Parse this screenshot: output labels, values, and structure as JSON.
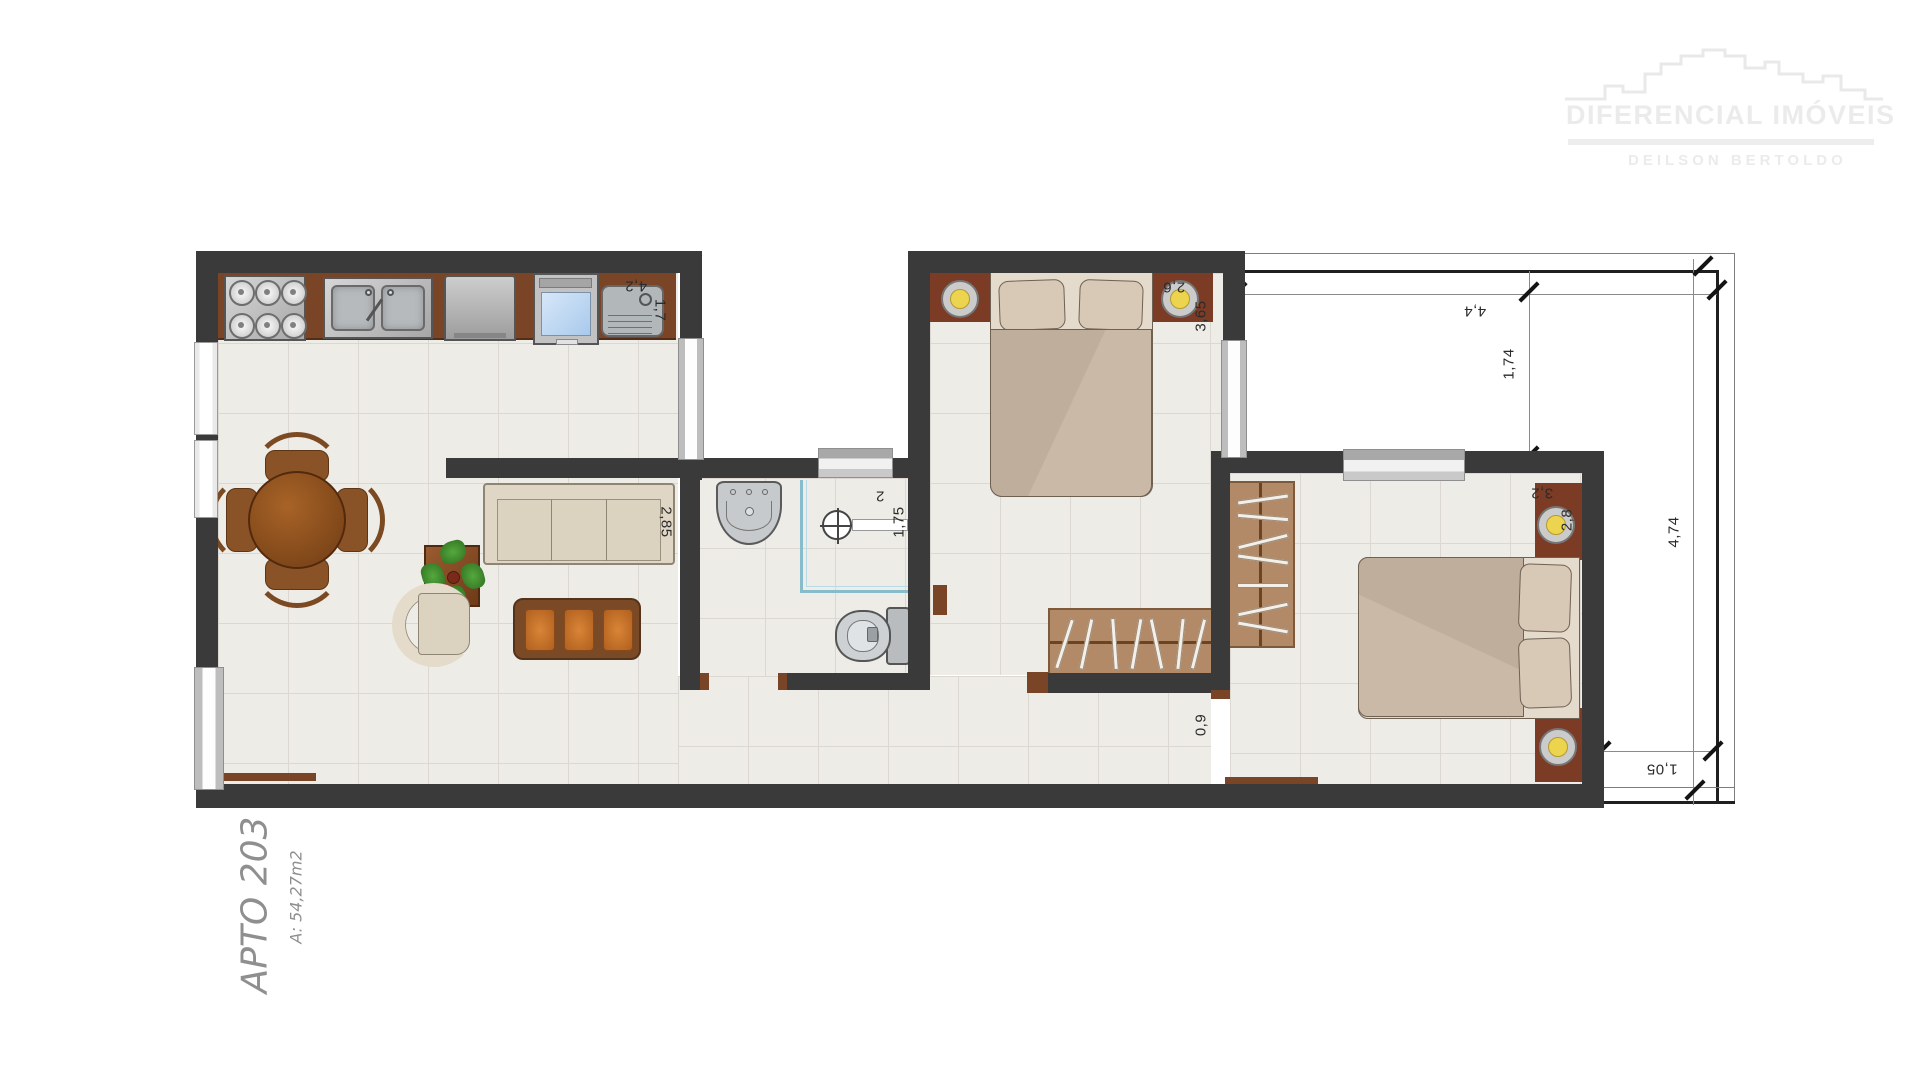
{
  "watermark": {
    "brand": "DIFERENCIAL IMÓVEIS",
    "agent": "DEILSON BERTOLDO"
  },
  "plan": {
    "title": "APTO 203",
    "area": "A: 54,27m2"
  },
  "dims": {
    "kitchen_width": "4,2",
    "kitchen_depth": "1,7",
    "sofa_length": "2,85",
    "bath_width": "2",
    "bath_depth": "1,75",
    "bedroom1_width": "2,6",
    "bedroom1_depth": "3,65",
    "bedroom2_width": "3,2",
    "bedroom2_depth": "2,8",
    "hall_door": "0,9",
    "balcony_width": "4,4",
    "balcony_top_depth": "1,74",
    "balcony_full_depth": "4,74",
    "balcony_side_width": "1,05"
  },
  "colors": {
    "wall": "#3a3a3a",
    "floor": "#eeece7",
    "tile_line": "#dcd8d1",
    "counter": "#7a4426",
    "closet": "#b28a68",
    "headboard": "#7b3b24",
    "bed_blanket": "#cbb9a8",
    "bed_mattress": "#e4dbcc",
    "sofa": "#e0d6c5",
    "cushion_orange": "#c8702a",
    "table_wood": "#8a5327",
    "plant_green": "#3f8f31",
    "shower_blue": "#86bccc",
    "lamp_yellow": "#ecd44e",
    "oven_blue": "#a9c9ec",
    "watermark": "#ebebeb",
    "dim_text": "#2b2b2b",
    "handwrite": "#8f8f8f"
  }
}
